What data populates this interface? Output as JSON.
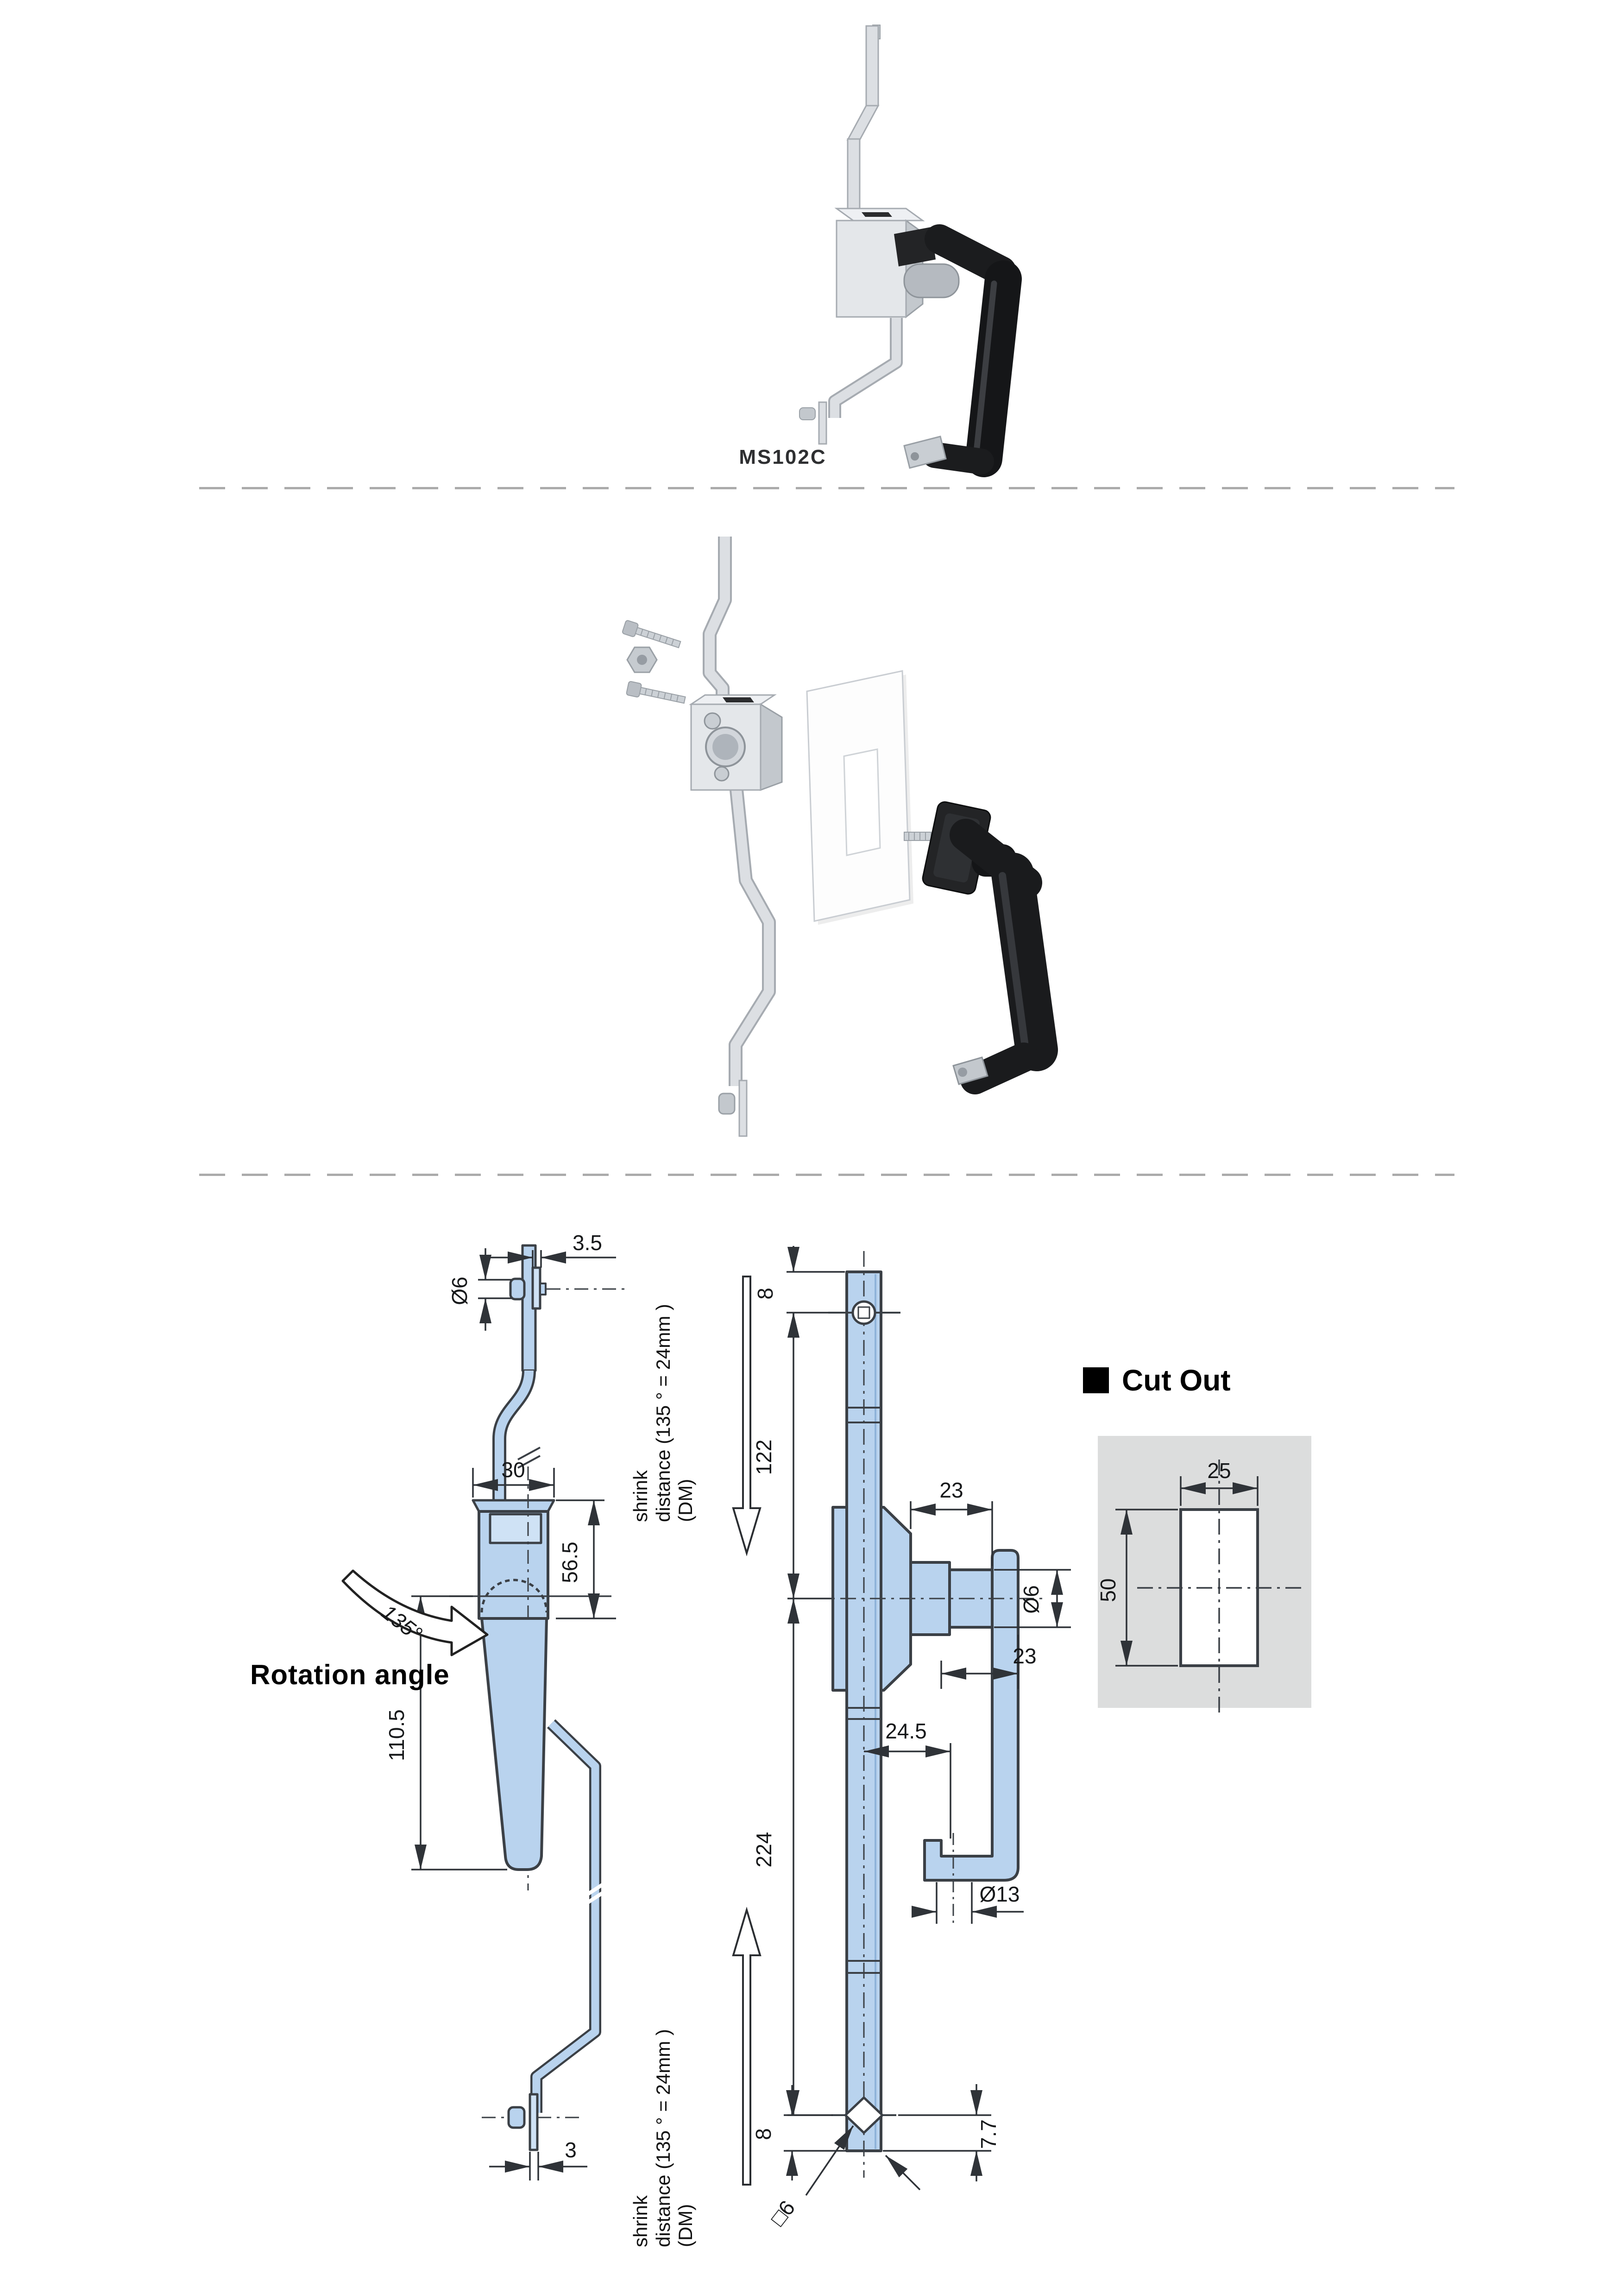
{
  "product": {
    "code": "MS102C"
  },
  "labels": {
    "rotation": "Rotation angle",
    "rotation_angle": "135°",
    "cutout_title": "Cut Out",
    "shrink_line1": "shrink",
    "shrink_line2": "distance (135 ° = 24mm )",
    "shrink_line3": "(DM)"
  },
  "dimensions": {
    "side_view": {
      "plate_thickness": "3.5",
      "head_diameter": "Ø6",
      "body_width": "30",
      "body_height": "56.5",
      "handle_length": "110.5",
      "rod_thickness": "3"
    },
    "front_view": {
      "top_hole_offset": "8",
      "upper_rod": "122",
      "arm_top": "23",
      "shaft_diameter": "Ø6",
      "arm_bottom": "23",
      "hook_offset": "24.5",
      "lower_rod": "224",
      "foot_diameter": "Ø13",
      "bottom_hole_offset": "8",
      "square_hole": "□6",
      "bottom_tip": "7.7"
    },
    "cutout": {
      "width": "25",
      "height": "50"
    }
  },
  "colors": {
    "drawing_fill": "#b9d3ee",
    "drawing_fill_light": "#cfe2f5",
    "drawing_line": "#3b4046",
    "dim_line": "#2f3338",
    "panel_gray": "#dcdddd",
    "metal_light": "#dcdfe3",
    "metal_mid": "#c3c8cd",
    "metal_edge": "#a6abb1",
    "handle_black": "#1a1b1d",
    "dash_gray": "#ababab"
  }
}
